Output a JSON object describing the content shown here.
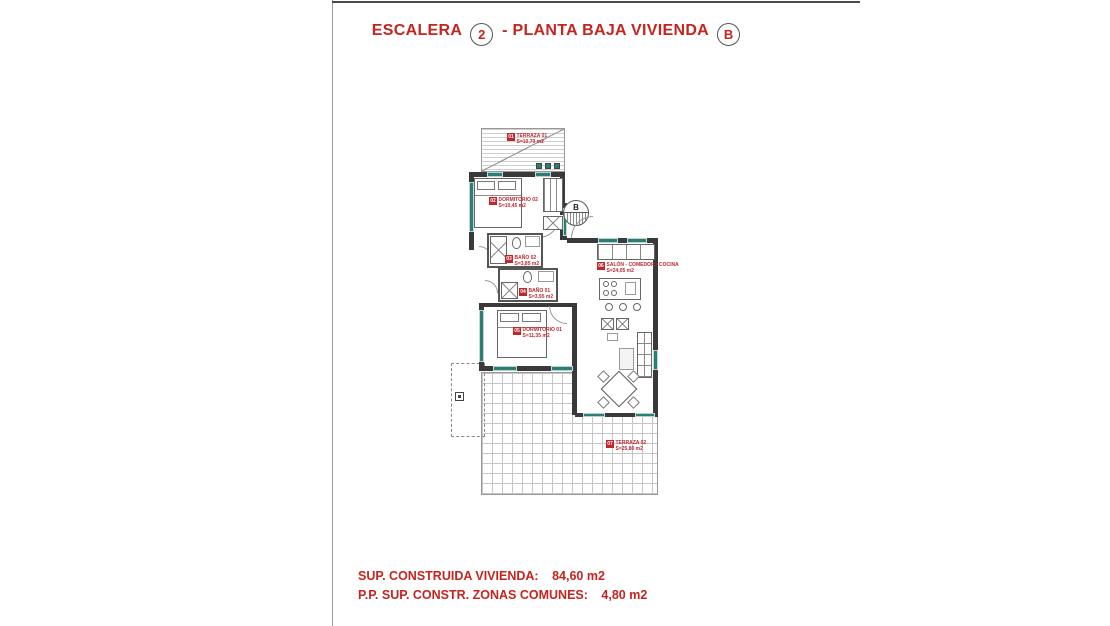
{
  "title": {
    "part1": "ESCALERA",
    "stair_number": "2",
    "part2": "- PLANTA BAJA VIVIENDA",
    "dwelling_letter": "B",
    "color": "#c5241f"
  },
  "summary": {
    "line1_label": "SUP. CONSTRUIDA VIVIENDA:",
    "line1_value": "84,60 m2",
    "line2_label": "P.P. SUP. CONSTR. ZONAS COMUNES:",
    "line2_value": "4,80 m2"
  },
  "floor_plan": {
    "entrance_letter": "B",
    "colors": {
      "wall": "#3a3a3a",
      "window": "#2e7d74",
      "label": "#c0272d"
    },
    "rooms": [
      {
        "number": "01",
        "name": "TERRAZA 01",
        "area": "S=10,70 m2"
      },
      {
        "number": "02",
        "name": "DORMITORIO 02",
        "area": "S=10,45 m2"
      },
      {
        "number": "03",
        "name": "BAÑO 02",
        "area": "S=3,85 m2"
      },
      {
        "number": "04",
        "name": "BAÑO 01",
        "area": "S=3,95 m2"
      },
      {
        "number": "05",
        "name": "DORMITORIO 01",
        "area": "S=11,35 m2"
      },
      {
        "number": "06",
        "name": "SALÓN - COMEDOR - COCINA",
        "area": "S=24,05 m2"
      },
      {
        "number": "07",
        "name": "TERRAZA 02",
        "area": "S=25,80 m2"
      }
    ]
  }
}
